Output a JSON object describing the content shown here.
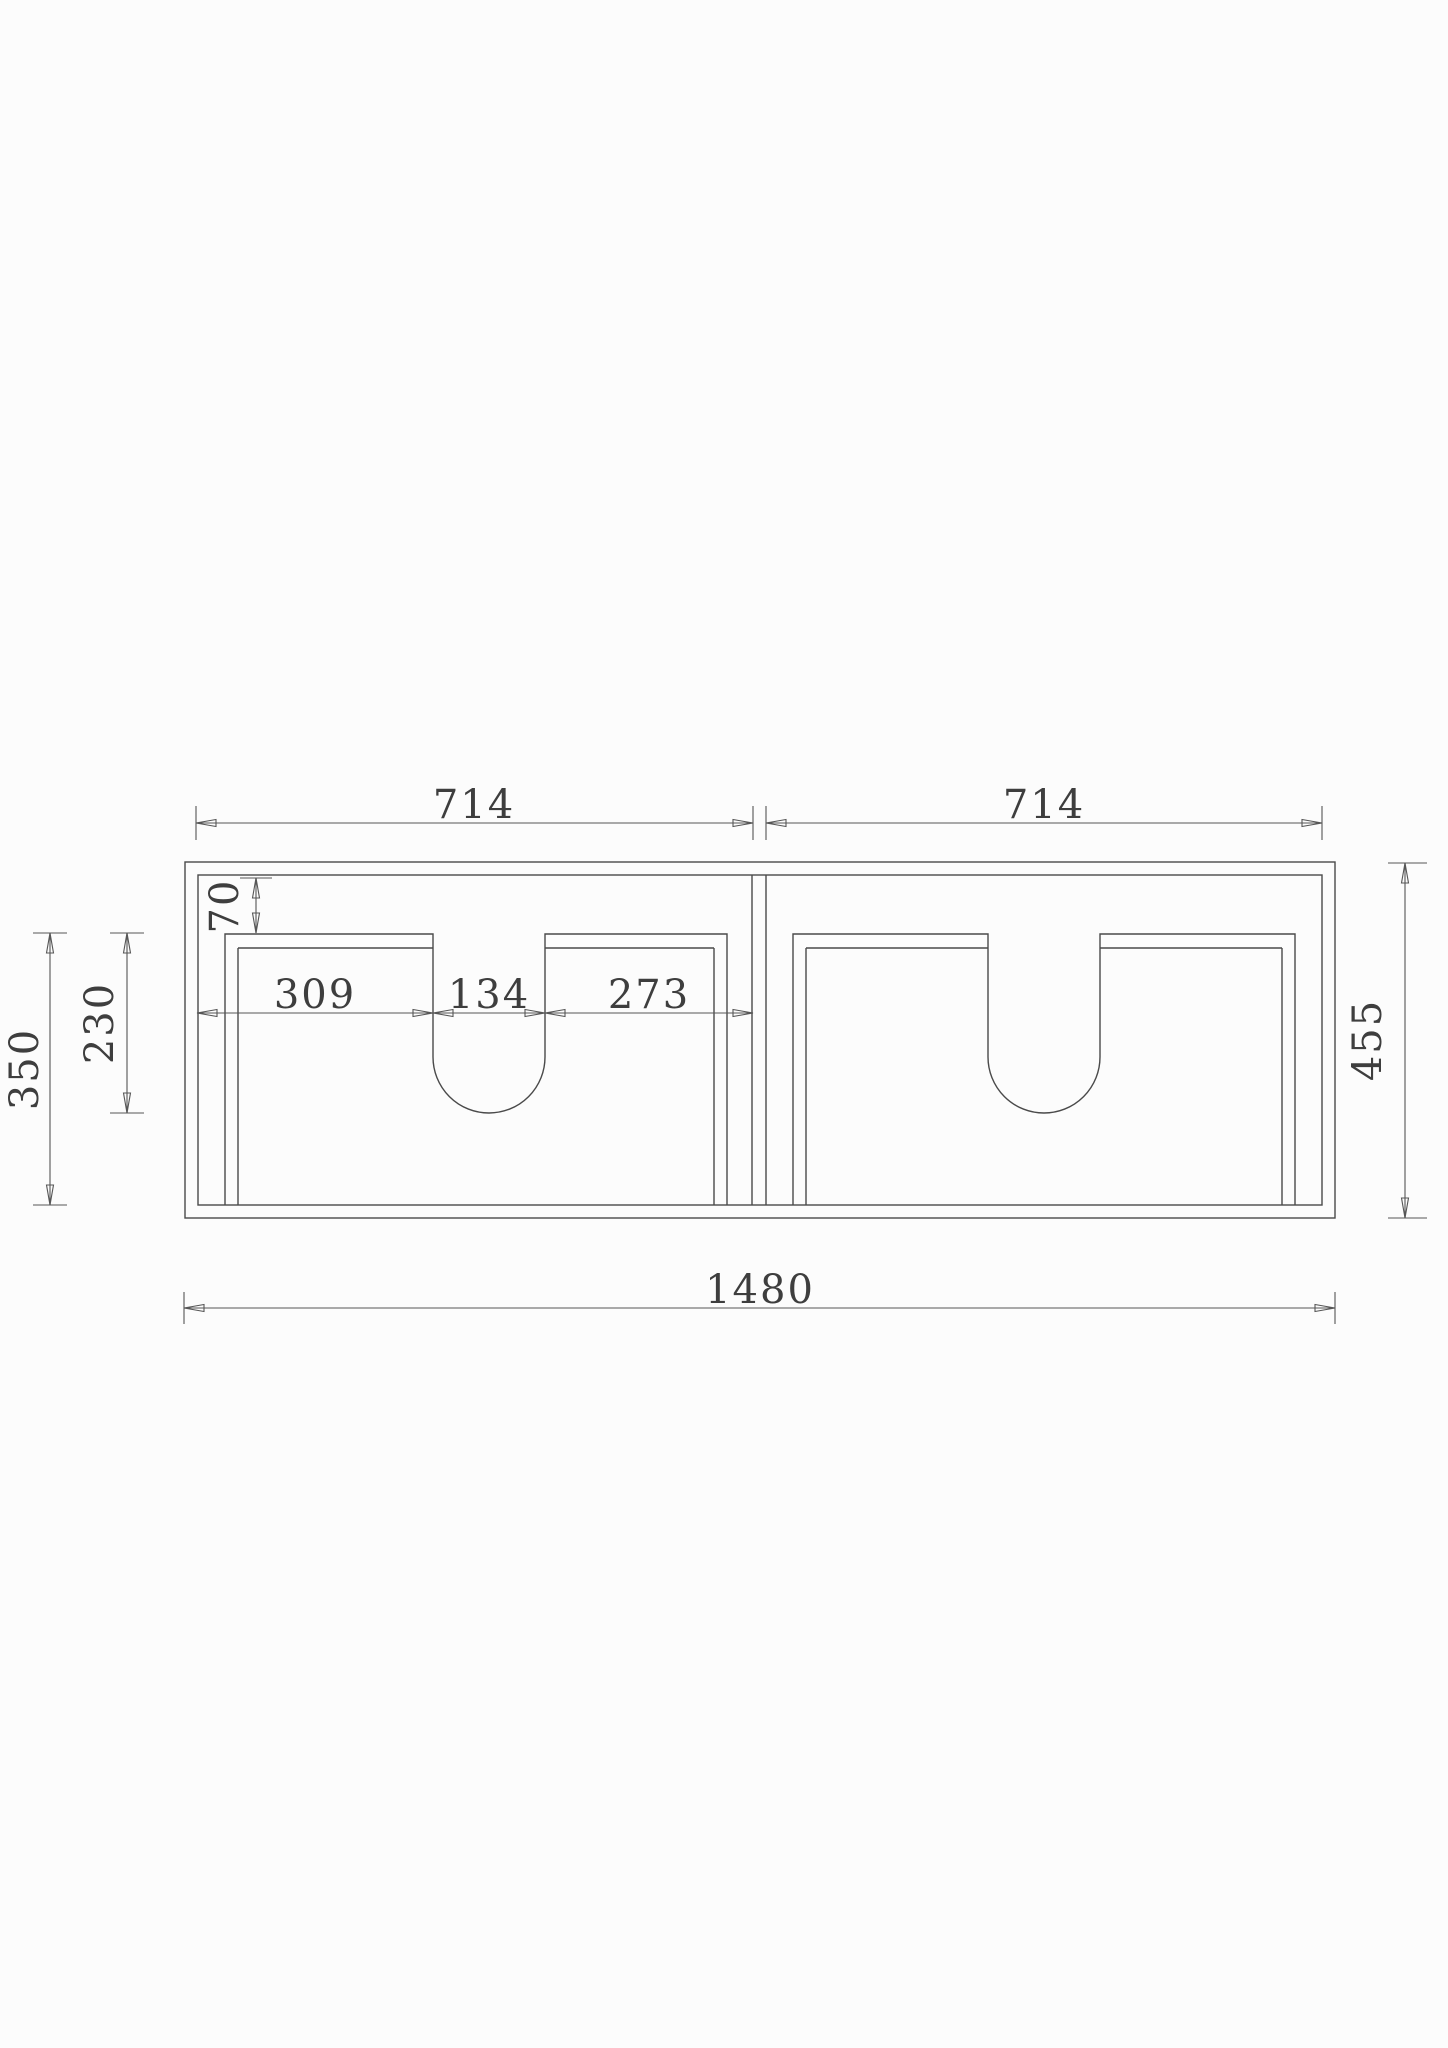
{
  "drawing": {
    "units": "mm",
    "view": "front elevation, twin-door basin cabinet with two U-shaped plumbing cutouts",
    "dimensions": {
      "top_width_left": "714",
      "top_width_right": "714",
      "inset_top": "70",
      "door_top_to_cutout_bottom": "230",
      "door_height": "350",
      "chain_left": "309",
      "chain_cutout": "134",
      "chain_right": "273",
      "overall_height": "455",
      "overall_width": "1480"
    }
  }
}
